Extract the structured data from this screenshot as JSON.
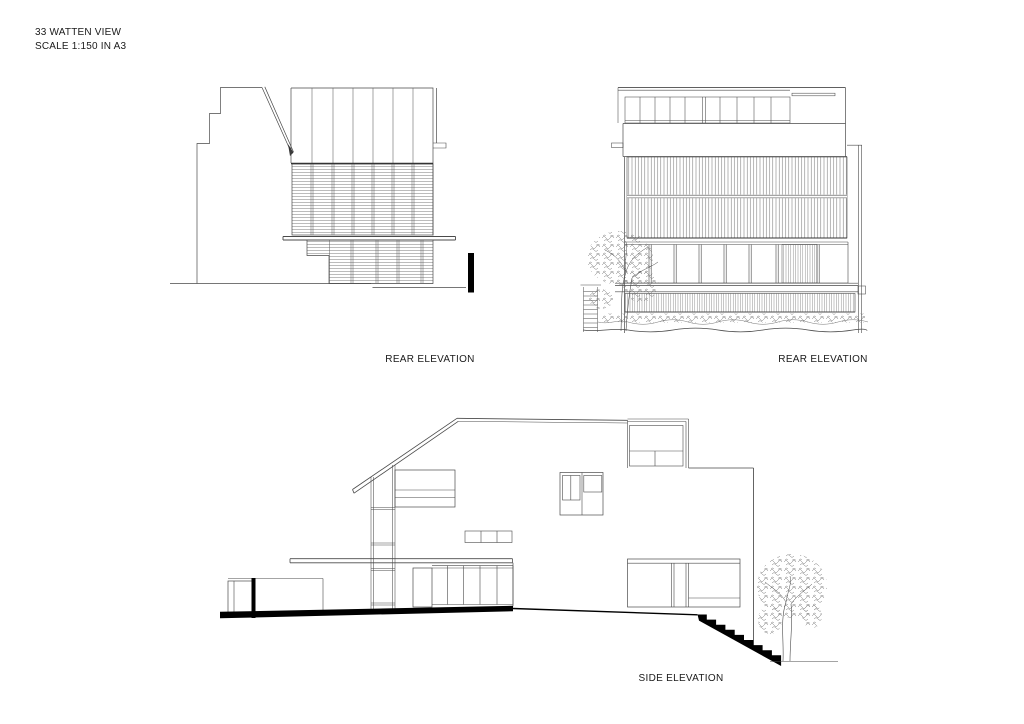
{
  "title_block": {
    "line1": "33 WATTEN VIEW",
    "line2": "SCALE 1:150 IN A3"
  },
  "drawings": {
    "rear_left": {
      "label": "REAR ELEVATION"
    },
    "rear_right": {
      "label": "REAR ELEVATION"
    },
    "side": {
      "label": "SIDE ELEVATION"
    }
  },
  "colors": {
    "line": "#4a4a4a",
    "hatch": "#777777",
    "solid": "#000000",
    "background": "#ffffff"
  }
}
